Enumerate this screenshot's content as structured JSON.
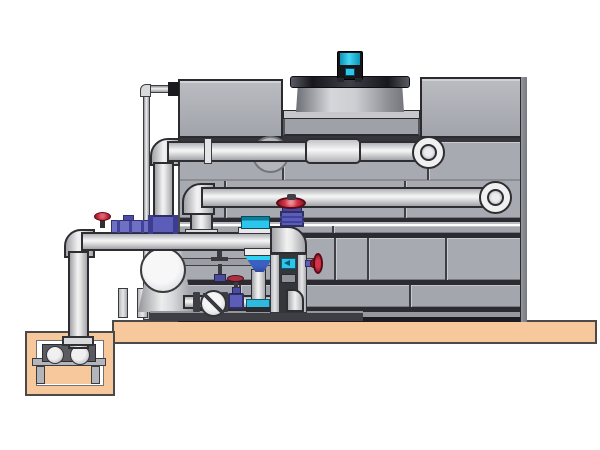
{
  "meta": {
    "domain": "Diagram",
    "description": "CAD-style side-view illustration of a closed-circuit cooling tower with external pump skid, valve manifold and below-grade sump pump pit. No text labels are present in the image."
  },
  "colors": {
    "background": "#ffffff",
    "slab": "#f6c89c",
    "slab_outline": "#4a4a4a",
    "panel": "#a8aab1",
    "panel_line": "#2b2b31",
    "pipe_outline": "#2e2e32",
    "shroud_dark": "#17171d",
    "motor_cyan": "#2cc5ec",
    "valve_red": "#d23549",
    "valve_purple": "#5c5db8",
    "valve_blue": "#3c60c2",
    "frame_dark": "#35363c"
  },
  "components": {
    "tower": "paneled cooling-tower casing with staggered panel seams",
    "fan_shroud": "cylindrical fan shroud on tower deck with dark top rim",
    "fan_motor": "cyan and black motor on top of fan shroud",
    "upper_pipe": "upper horizontal pipe entering tower through round port, elbow at right",
    "lower_pipe": "second horizontal pipe with left elbow and right elbow into tower",
    "thin_drain_pipe": "small-bore pipe from tower top-left running down to grade",
    "suction_pipe": "large suction line rising from sump pit with elbow to pump skid",
    "pump_vessel": "round-faced pump/separator vessel on skid",
    "check_valve": "wafer check valve with diagonal disc mark",
    "gate_valves": "purple-bodied gate valves with red handwheels",
    "float_device": "cyan control device on suction header",
    "blue_funnel_valve": "blue pressure-reducing valve dropping to bottom manifold",
    "skid_frame": "gray channel frame with dark interior and cyan insert",
    "sump_pit": "tan concrete pit with stand-mounted sump pump",
    "slab": "tan concrete equipment slab"
  }
}
